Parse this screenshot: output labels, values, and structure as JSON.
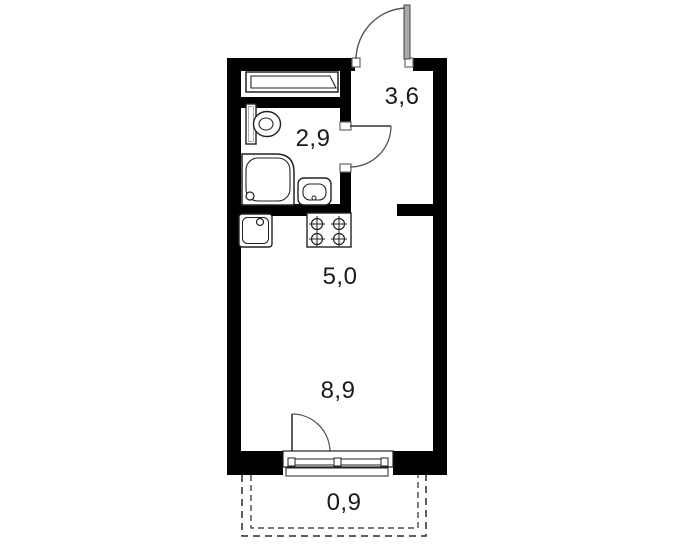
{
  "title": "studio-apartment-floor-plan",
  "rooms": {
    "hallway": {
      "label": "3,6"
    },
    "bathroom": {
      "label": "2,9"
    },
    "kitchen_zone": {
      "label": "5,0"
    },
    "living_zone": {
      "label": "8,9"
    },
    "balcony": {
      "label": "0,9"
    }
  },
  "fixtures": [
    "entrance-door",
    "bathroom-door",
    "balcony-door",
    "window-unit",
    "wardrobe",
    "toilet",
    "shower-tray",
    "washbasin",
    "kitchen-sink",
    "stove-4-burner",
    "balcony-dashed-outline"
  ],
  "colors": {
    "wall": "#000000",
    "line": "#222222",
    "door_leaf": "#aaaaaa",
    "swing_arc": "#555555",
    "text": "#1a1a1a",
    "background": "#ffffff"
  }
}
